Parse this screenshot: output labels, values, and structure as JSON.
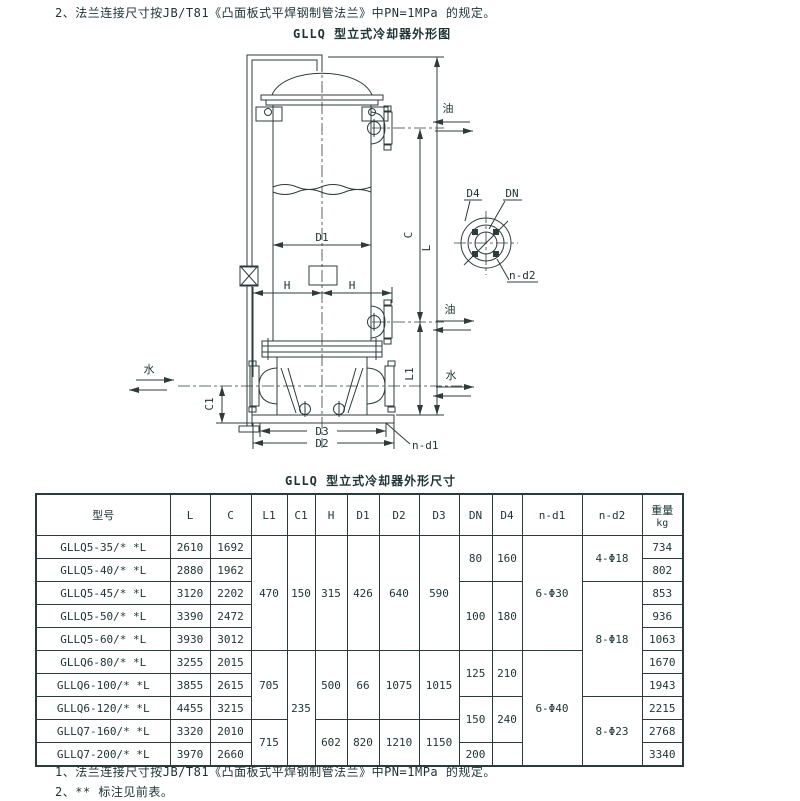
{
  "page": {
    "note_top": "2、法兰连接尺寸按JB/T81《凸面板式平焊钢制管法兰》中PN=1MPa 的规定。",
    "drawing_title": "GLLQ 型立式冷却器外形图",
    "table_title": "GLLQ 型立式冷却器外形尺寸",
    "note_bottom_1": "1、法兰连接尺寸按JB/T81《凸面板式平焊钢制管法兰》中PN=1MPa 的规定。",
    "note_bottom_2": "2、** 标注见前表。"
  },
  "drawing": {
    "labels": {
      "oil": "油",
      "water": "水",
      "L": "L",
      "C": "C",
      "L1": "L1",
      "C1": "C1",
      "H": "H",
      "D1": "D1",
      "D2": "D2",
      "D3": "D3",
      "D4": "D4",
      "DN": "DN",
      "n_d1": "n-d1",
      "n_d2": "n-d2"
    }
  },
  "table": {
    "headers": {
      "model": "型号",
      "L": "L",
      "C": "C",
      "L1": "L1",
      "C1": "C1",
      "H": "H",
      "D1": "D1",
      "D2": "D2",
      "D3": "D3",
      "DN": "DN",
      "D4": "D4",
      "n_d1": "n-d1",
      "n_d2": "n-d2",
      "weight": "重量",
      "weight_unit": "kg"
    },
    "rows": [
      {
        "model": "GLLQ5-35/* *L",
        "L": "2610",
        "C": "1692",
        "weight": "734"
      },
      {
        "model": "GLLQ5-40/* *L",
        "L": "2880",
        "C": "1962",
        "weight": "802"
      },
      {
        "model": "GLLQ5-45/* *L",
        "L": "3120",
        "C": "2202",
        "weight": "853"
      },
      {
        "model": "GLLQ5-50/* *L",
        "L": "3390",
        "C": "2472",
        "weight": "936"
      },
      {
        "model": "GLLQ5-60/* *L",
        "L": "3930",
        "C": "3012",
        "weight": "1063"
      },
      {
        "model": "GLLQ6-80/* *L",
        "L": "3255",
        "C": "2015",
        "weight": "1670"
      },
      {
        "model": "GLLQ6-100/* *L",
        "L": "3855",
        "C": "2615",
        "weight": "1943"
      },
      {
        "model": "GLLQ6-120/* *L",
        "L": "4455",
        "C": "3215",
        "weight": "2215"
      },
      {
        "model": "GLLQ7-160/* *L",
        "L": "3320",
        "C": "2010",
        "weight": "2768"
      },
      {
        "model": "GLLQ7-200/* *L",
        "L": "3970",
        "C": "2660",
        "weight": "3340"
      }
    ],
    "merged": {
      "L1": [
        "470",
        "705",
        "715"
      ],
      "C1": [
        "150",
        "235"
      ],
      "H": [
        "315",
        "500",
        "602"
      ],
      "D1": [
        "426",
        "66",
        "820"
      ],
      "D2": [
        "640",
        "1075",
        "1210"
      ],
      "D3": [
        "590",
        "1015",
        "1150"
      ],
      "DN": [
        "80",
        "100",
        "125",
        "150",
        "200"
      ],
      "D4": [
        "160",
        "180",
        "210",
        "240",
        ""
      ],
      "n_d1": [
        "6-Φ30",
        "6-Φ40"
      ],
      "n_d2": [
        "4-Φ18",
        "8-Φ18",
        "8-Φ23"
      ]
    }
  },
  "colors": {
    "text": "#1d3336",
    "line": "#2e3b3b",
    "background": "#ffffff"
  }
}
